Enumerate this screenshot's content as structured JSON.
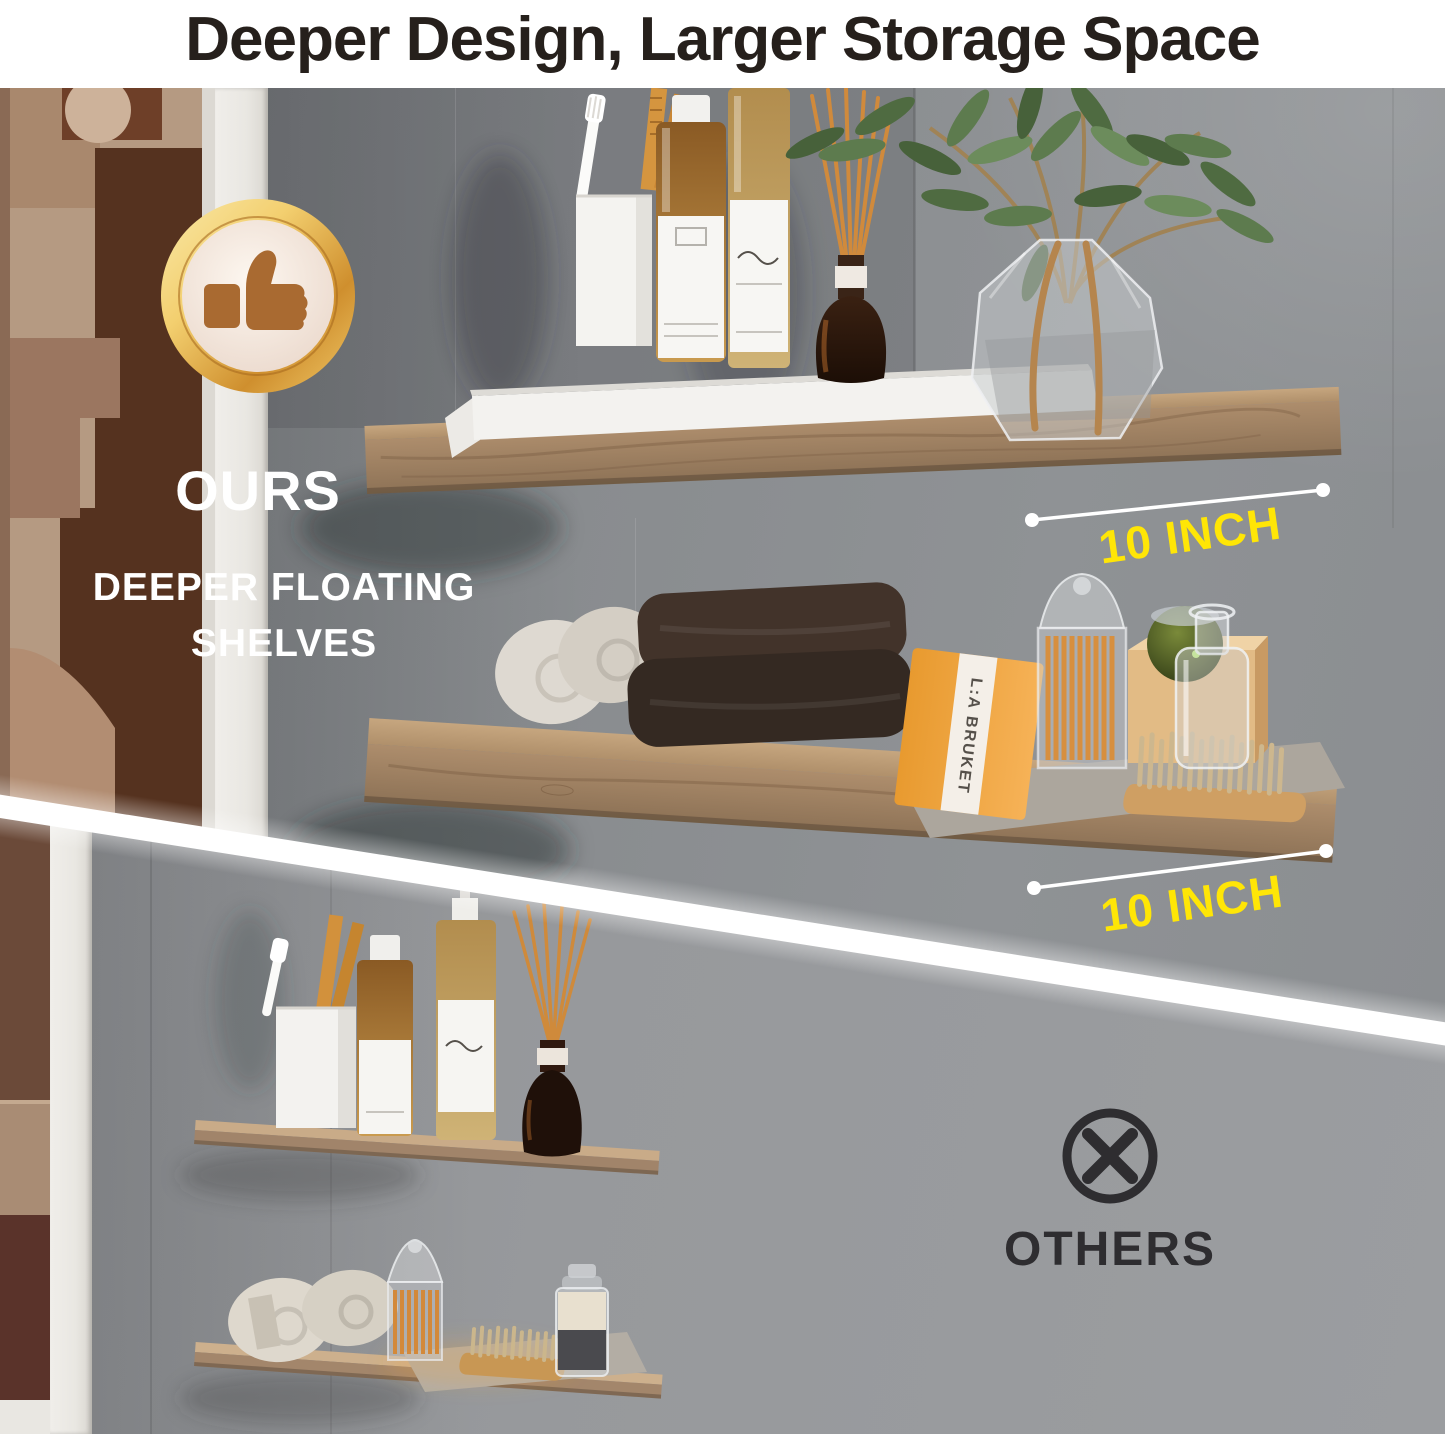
{
  "title": "Deeper Design, Larger Storage Space",
  "ours": {
    "badge_icon": "thumbs-up",
    "label": "OURS",
    "subtitle_line1": "DEEPER FLOATING",
    "subtitle_line2": "SHELVES",
    "shelf_depth_top": "10 INCH",
    "shelf_depth_bottom": "10 INCH"
  },
  "others": {
    "icon": "x-circle",
    "label": "OTHERS"
  },
  "items": {
    "soap_box_brand": "L:A BRUKET"
  },
  "colors": {
    "measure_yellow": "#FFE606",
    "badge_gold": "#E2A944",
    "title_text": "#26201C",
    "others_text": "#2E2D30",
    "wall_ours": "#8B8E91",
    "wall_others": "#97999C",
    "wood": "#AB8A68"
  }
}
